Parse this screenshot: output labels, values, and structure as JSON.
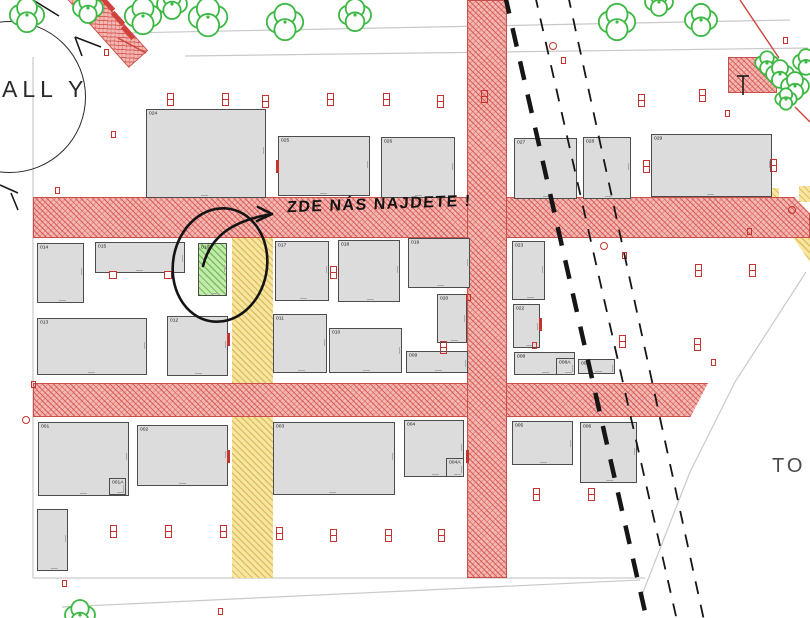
{
  "map": {
    "hall_label": "ALL Y",
    "destination_label": "TO I",
    "annotation_text": "ZDE NÁS NAJDETE !",
    "highlighted_plot": "016",
    "colors": {
      "road_fill": "#f3b8b3",
      "road_hatch": "#d34a44",
      "road_border": "#c94f48",
      "path_fill": "#f6e6a2",
      "path_hatch": "#deb954",
      "plot_fill": "#dcdcdc",
      "plot_border": "#4c4c4c",
      "highlight_fill": "#c5eaae",
      "highlight_hatch": "#68ba4c",
      "tree_green": "#3cb843",
      "marker_red": "#c33430",
      "ink": "#161616",
      "parcel_line": "#c9c9c9"
    },
    "plots": [
      {
        "id": "024",
        "x": 146,
        "y": 109,
        "w": 120,
        "h": 89,
        "hl": 0
      },
      {
        "id": "025",
        "x": 278,
        "y": 136,
        "w": 92,
        "h": 60,
        "hl": 0
      },
      {
        "id": "026",
        "x": 381,
        "y": 137,
        "w": 74,
        "h": 61,
        "hl": 0
      },
      {
        "id": "027",
        "x": 514,
        "y": 138,
        "w": 63,
        "h": 61,
        "hl": 0
      },
      {
        "id": "028",
        "x": 583,
        "y": 137,
        "w": 48,
        "h": 62,
        "hl": 0
      },
      {
        "id": "029",
        "x": 651,
        "y": 134,
        "w": 121,
        "h": 63,
        "hl": 0
      },
      {
        "id": "014",
        "x": 37,
        "y": 243,
        "w": 47,
        "h": 60,
        "hl": 0
      },
      {
        "id": "015",
        "x": 95,
        "y": 242,
        "w": 90,
        "h": 31,
        "hl": 0
      },
      {
        "id": "016",
        "x": 198,
        "y": 243,
        "w": 29,
        "h": 53,
        "hl": 1
      },
      {
        "id": "017",
        "x": 275,
        "y": 241,
        "w": 54,
        "h": 60,
        "hl": 0
      },
      {
        "id": "018",
        "x": 338,
        "y": 240,
        "w": 62,
        "h": 62,
        "hl": 0
      },
      {
        "id": "019",
        "x": 408,
        "y": 238,
        "w": 62,
        "h": 50,
        "hl": 0
      },
      {
        "id": "023",
        "x": 512,
        "y": 241,
        "w": 33,
        "h": 59,
        "hl": 0
      },
      {
        "id": "020",
        "x": 437,
        "y": 294,
        "w": 30,
        "h": 49,
        "hl": 0
      },
      {
        "id": "022",
        "x": 513,
        "y": 304,
        "w": 27,
        "h": 44,
        "hl": 0
      },
      {
        "id": "013",
        "x": 37,
        "y": 318,
        "w": 110,
        "h": 57,
        "hl": 0
      },
      {
        "id": "012",
        "x": 167,
        "y": 316,
        "w": 61,
        "h": 60,
        "hl": 0
      },
      {
        "id": "011",
        "x": 273,
        "y": 314,
        "w": 54,
        "h": 59,
        "hl": 0
      },
      {
        "id": "010",
        "x": 329,
        "y": 328,
        "w": 73,
        "h": 45,
        "hl": 0
      },
      {
        "id": "009",
        "x": 406,
        "y": 351,
        "w": 62,
        "h": 22,
        "hl": 0
      },
      {
        "id": "008",
        "x": 514,
        "y": 352,
        "w": 61,
        "h": 23,
        "hl": 0
      },
      {
        "id": "008A",
        "x": 556,
        "y": 358,
        "w": 19,
        "h": 17,
        "hl": 0
      },
      {
        "id": "007",
        "x": 578,
        "y": 359,
        "w": 37,
        "h": 15,
        "hl": 0
      },
      {
        "id": "001",
        "x": 38,
        "y": 422,
        "w": 91,
        "h": 74,
        "hl": 0
      },
      {
        "id": "001A",
        "x": 109,
        "y": 478,
        "w": 17,
        "h": 17,
        "hl": 0
      },
      {
        "id": "002",
        "x": 137,
        "y": 425,
        "w": 91,
        "h": 61,
        "hl": 0
      },
      {
        "id": "003",
        "x": 273,
        "y": 422,
        "w": 122,
        "h": 73,
        "hl": 0
      },
      {
        "id": "004",
        "x": 404,
        "y": 420,
        "w": 60,
        "h": 57,
        "hl": 0
      },
      {
        "id": "004A",
        "x": 446,
        "y": 458,
        "w": 18,
        "h": 19,
        "hl": 0
      },
      {
        "id": "005",
        "x": 512,
        "y": 421,
        "w": 61,
        "h": 44,
        "hl": 0
      },
      {
        "id": "006",
        "x": 580,
        "y": 422,
        "w": 57,
        "h": 61,
        "hl": 0
      },
      {
        "id": "",
        "x": 37,
        "y": 509,
        "w": 31,
        "h": 62,
        "hl": 0
      }
    ],
    "markers": [
      {
        "x": 167,
        "y": 93,
        "t": "m"
      },
      {
        "x": 222,
        "y": 93,
        "t": "m"
      },
      {
        "x": 262,
        "y": 95,
        "t": "m"
      },
      {
        "x": 327,
        "y": 93,
        "t": "m"
      },
      {
        "x": 383,
        "y": 93,
        "t": "m"
      },
      {
        "x": 437,
        "y": 95,
        "t": "m"
      },
      {
        "x": 481,
        "y": 90,
        "t": "m"
      },
      {
        "x": 638,
        "y": 94,
        "t": "m"
      },
      {
        "x": 699,
        "y": 89,
        "t": "m"
      },
      {
        "x": 643,
        "y": 160,
        "t": "m"
      },
      {
        "x": 770,
        "y": 159,
        "t": "m"
      },
      {
        "x": 330,
        "y": 266,
        "t": "m"
      },
      {
        "x": 695,
        "y": 264,
        "t": "m"
      },
      {
        "x": 749,
        "y": 264,
        "t": "m"
      },
      {
        "x": 619,
        "y": 335,
        "t": "m"
      },
      {
        "x": 694,
        "y": 338,
        "t": "m"
      },
      {
        "x": 440,
        "y": 341,
        "t": "m"
      },
      {
        "x": 533,
        "y": 488,
        "t": "m"
      },
      {
        "x": 588,
        "y": 488,
        "t": "m"
      },
      {
        "x": 110,
        "y": 525,
        "t": "m"
      },
      {
        "x": 165,
        "y": 525,
        "t": "m"
      },
      {
        "x": 220,
        "y": 525,
        "t": "m"
      },
      {
        "x": 276,
        "y": 527,
        "t": "m"
      },
      {
        "x": 330,
        "y": 529,
        "t": "m"
      },
      {
        "x": 385,
        "y": 529,
        "t": "m"
      },
      {
        "x": 438,
        "y": 529,
        "t": "m"
      },
      {
        "x": 725,
        "y": 110,
        "t": "s"
      },
      {
        "x": 622,
        "y": 252,
        "t": "s"
      },
      {
        "x": 711,
        "y": 359,
        "t": "s"
      },
      {
        "x": 104,
        "y": 49,
        "t": "s"
      },
      {
        "x": 111,
        "y": 131,
        "t": "s"
      },
      {
        "x": 55,
        "y": 187,
        "t": "s"
      },
      {
        "x": 62,
        "y": 580,
        "t": "s"
      },
      {
        "x": 218,
        "y": 608,
        "t": "s"
      },
      {
        "x": 783,
        "y": 37,
        "t": "s"
      },
      {
        "x": 747,
        "y": 228,
        "t": "s"
      },
      {
        "x": 466,
        "y": 294,
        "t": "s"
      },
      {
        "x": 532,
        "y": 342,
        "t": "s"
      },
      {
        "x": 31,
        "y": 381,
        "t": "s"
      },
      {
        "x": 561,
        "y": 57,
        "t": "s"
      },
      {
        "x": 600,
        "y": 242,
        "t": "c"
      },
      {
        "x": 788,
        "y": 206,
        "t": "c"
      },
      {
        "x": 22,
        "y": 416,
        "t": "c"
      },
      {
        "x": 549,
        "y": 42,
        "t": "c"
      },
      {
        "x": 276,
        "y": 160,
        "t": "t"
      },
      {
        "x": 227,
        "y": 333,
        "t": "t"
      },
      {
        "x": 227,
        "y": 450,
        "t": "t"
      },
      {
        "x": 466,
        "y": 450,
        "t": "t"
      },
      {
        "x": 539,
        "y": 318,
        "t": "t"
      },
      {
        "x": 109,
        "y": 271,
        "t": "d"
      },
      {
        "x": 164,
        "y": 271,
        "t": "d"
      }
    ],
    "trees": [
      {
        "x": 27,
        "y": 15,
        "r": 16
      },
      {
        "x": 88,
        "y": 8,
        "r": 14
      },
      {
        "x": 143,
        "y": 16,
        "r": 17
      },
      {
        "x": 172,
        "y": 4,
        "r": 14
      },
      {
        "x": 208,
        "y": 17,
        "r": 18
      },
      {
        "x": 285,
        "y": 22,
        "r": 17
      },
      {
        "x": 355,
        "y": 15,
        "r": 15
      },
      {
        "x": 617,
        "y": 22,
        "r": 17
      },
      {
        "x": 659,
        "y": 2,
        "r": 13
      },
      {
        "x": 701,
        "y": 20,
        "r": 15
      },
      {
        "x": 767,
        "y": 63,
        "r": 11
      },
      {
        "x": 780,
        "y": 74,
        "r": 13
      },
      {
        "x": 795,
        "y": 86,
        "r": 13
      },
      {
        "x": 806,
        "y": 62,
        "r": 12
      },
      {
        "x": 786,
        "y": 99,
        "r": 10
      },
      {
        "x": 80,
        "y": 615,
        "r": 14
      }
    ],
    "dashed_lines": [
      {
        "x1": 505,
        "y1": -5,
        "x2": 648,
        "y2": 625,
        "w": 4.5,
        "dash": "19 15"
      },
      {
        "x1": 535,
        "y1": -5,
        "x2": 678,
        "y2": 625,
        "w": 1.8,
        "dash": "13 11"
      },
      {
        "x1": 568,
        "y1": -5,
        "x2": 705,
        "y2": 625,
        "w": 1.8,
        "dash": "13 11"
      }
    ],
    "boundary_lines": [
      {
        "x1": 125,
        "y1": 33,
        "x2": 790,
        "y2": 20
      },
      {
        "x1": 185,
        "y1": 56,
        "x2": 808,
        "y2": 48
      },
      {
        "x1": 33,
        "y1": 57,
        "x2": 33,
        "y2": 578
      },
      {
        "x1": 33,
        "y1": 578,
        "x2": 645,
        "y2": 578
      },
      {
        "x1": 62,
        "y1": 607,
        "x2": 640,
        "y2": 580
      },
      {
        "x1": 806,
        "y1": 272,
        "x2": 735,
        "y2": 382
      },
      {
        "x1": 735,
        "y1": 382,
        "x2": 690,
        "y2": 472
      },
      {
        "x1": 690,
        "y1": 472,
        "x2": 640,
        "y2": 600
      }
    ],
    "ink_lines": [
      {
        "x1": 33,
        "y1": 0,
        "x2": 59,
        "y2": 16
      },
      {
        "x1": 75,
        "y1": 37,
        "x2": 101,
        "y2": 47
      },
      {
        "x1": 75,
        "y1": 37,
        "x2": 82,
        "y2": 56
      },
      {
        "x1": 0,
        "y1": 185,
        "x2": 18,
        "y2": 193
      },
      {
        "x1": 11,
        "y1": 193,
        "x2": 18,
        "y2": 210
      },
      {
        "x1": 737,
        "y1": 76,
        "x2": 749,
        "y2": 76
      },
      {
        "x1": 743,
        "y1": 76,
        "x2": 743,
        "y2": 95
      }
    ],
    "red_lines": [
      {
        "x1": 740,
        "y1": 0,
        "x2": 779,
        "y2": 58
      },
      {
        "x1": 795,
        "y1": 107,
        "x2": 810,
        "y2": 122
      },
      {
        "x1": 118,
        "y1": 38,
        "x2": 146,
        "y2": 53
      }
    ]
  }
}
